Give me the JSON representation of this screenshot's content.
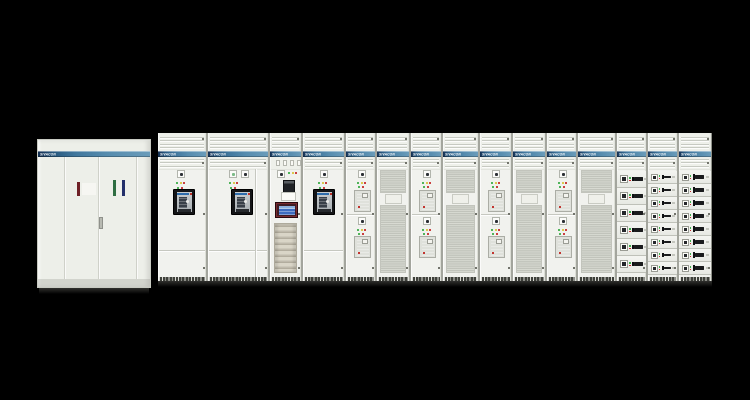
{
  "scene": {
    "background_color": "#000000",
    "brand": "SIVACON",
    "subject": "low-voltage-switchgear-lineup"
  },
  "colors": {
    "band_navy": "#142f52",
    "band_blue": "#568cae",
    "panel": "#eef0ea",
    "indicator_green": "#3fae4c",
    "indicator_yellow": "#d9c43e",
    "indicator_red": "#c62f2f",
    "breaker_bezel": "#141517",
    "breaker_label_blue": "#2e6cac",
    "hmi_bezel": "#401d24",
    "hmi_screen": "#3e6cc0",
    "mesh_gray": "#d9dbd3",
    "handle_black": "#191a1c",
    "busbar_tan": "#ccc8ba"
  },
  "left_cabinet": {
    "logo": "SIVACON",
    "door_count": 4,
    "stickers": [
      {
        "name": "sticker-red",
        "color": "#6e2026"
      },
      {
        "name": "sticker-white",
        "color": "#f6f6f2"
      },
      {
        "name": "sticker-green",
        "color": "#2f6e42"
      },
      {
        "name": "sticker-white-2",
        "color": "#f0f1eb"
      },
      {
        "name": "sticker-navy",
        "color": "#23306a"
      }
    ]
  },
  "lineup": {
    "sections": [
      {
        "id": "incomer-1",
        "type": "breaker-panel",
        "width": 50,
        "logo": "SIVACON",
        "equipment": [
          "breaker-controller",
          "indicator-lights",
          "air-circuit-breaker"
        ],
        "indicator_rows": [
          [
            "green",
            "yellow",
            "red"
          ],
          [
            "green",
            "red"
          ]
        ]
      },
      {
        "id": "incomer-2",
        "type": "breaker-panel",
        "width": 62,
        "logo": "SIVACON",
        "equipment": [
          "power-meter",
          "breaker-controller",
          "indicator-lights",
          "air-circuit-breaker"
        ],
        "indicator_rows": [
          [
            "green",
            "yellow",
            "red"
          ],
          [
            "green",
            "red"
          ]
        ]
      },
      {
        "id": "control-panel",
        "type": "control-panel",
        "width": 33,
        "logo": "SIVACON",
        "equipment": [
          "terminal-blocks",
          "controller",
          "relay",
          "label-box",
          "touch-panel",
          "busbar-rack"
        ],
        "indicator_rows": [
          [
            "green",
            "yellow",
            "red"
          ]
        ]
      },
      {
        "id": "incomer-3",
        "type": "breaker-panel",
        "width": 43,
        "logo": "SIVACON",
        "equipment": [
          "breaker-controller",
          "indicator-lights",
          "air-circuit-breaker"
        ],
        "indicator_rows": [
          [
            "green",
            "yellow",
            "red"
          ],
          [
            "green",
            "red"
          ]
        ]
      },
      {
        "id": "feeder-1",
        "type": "feeder-panel",
        "width": 31,
        "logo": "SIVACON",
        "bays": 2,
        "indicator_rows": [
          [
            "green",
            "yellow",
            "red"
          ],
          [
            "green",
            "red"
          ]
        ]
      },
      {
        "id": "vent-door-1",
        "type": "ventilated-door",
        "width": 34,
        "logo": "SIVACON"
      },
      {
        "id": "feeder-2",
        "type": "feeder-panel",
        "width": 32,
        "logo": "SIVACON",
        "bays": 2,
        "indicator_rows": [
          [
            "green",
            "yellow",
            "red"
          ],
          [
            "green",
            "red"
          ]
        ]
      },
      {
        "id": "vent-door-2",
        "type": "ventilated-door",
        "width": 37,
        "logo": "SIVACON"
      },
      {
        "id": "feeder-3",
        "type": "feeder-panel",
        "width": 33,
        "logo": "SIVACON",
        "bays": 2,
        "indicator_rows": [
          [
            "green",
            "yellow",
            "red"
          ],
          [
            "green",
            "red"
          ]
        ]
      },
      {
        "id": "vent-door-3",
        "type": "ventilated-door",
        "width": 34,
        "logo": "SIVACON"
      },
      {
        "id": "feeder-4",
        "type": "feeder-panel",
        "width": 31,
        "logo": "SIVACON",
        "bays": 2,
        "indicator_rows": [
          [
            "green",
            "yellow",
            "red"
          ],
          [
            "green",
            "red"
          ]
        ]
      },
      {
        "id": "vent-door-4",
        "type": "ventilated-door",
        "width": 39,
        "logo": "SIVACON"
      },
      {
        "id": "mcc-column-1",
        "type": "drawer-column",
        "width": 31,
        "logo": "SIVACON",
        "drawer_count": 6,
        "drawer_size": "large",
        "drawer_indicators": [
          "green",
          "red"
        ]
      },
      {
        "id": "mcc-column-2",
        "type": "drawer-column",
        "width": 31,
        "logo": "SIVACON",
        "drawer_count": 8,
        "drawer_size": "small",
        "drawer_indicators": [
          "green",
          "red"
        ]
      },
      {
        "id": "mcc-column-3",
        "type": "drawer-column",
        "width": 33,
        "logo": "SIVACON",
        "drawer_count": 8,
        "drawer_size": "wide",
        "drawer_indicators": [
          "green",
          "red"
        ]
      }
    ]
  }
}
